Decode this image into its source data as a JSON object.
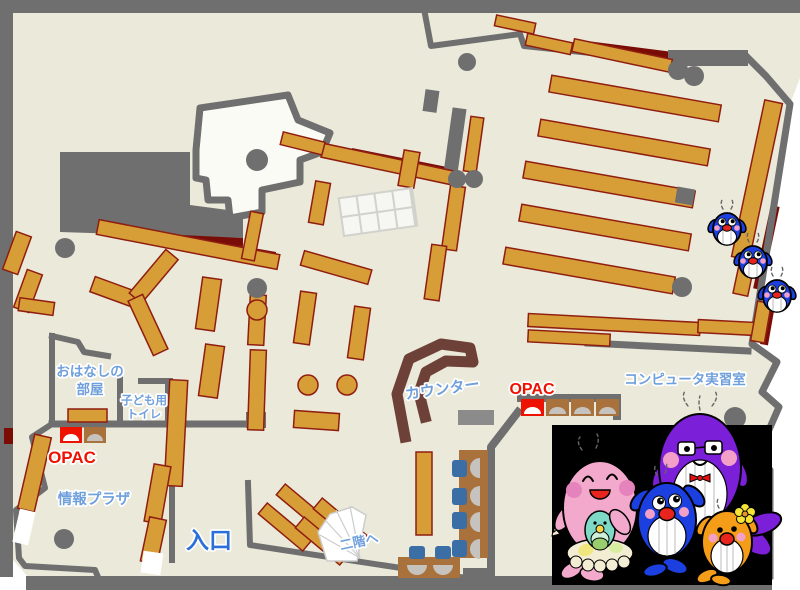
{
  "labels": {
    "story_room": {
      "line1": "おはなしの",
      "line2": "部屋"
    },
    "kids_toilet": {
      "line1": "子ども用",
      "line2": "トイレ"
    },
    "opac_children": "OPAC",
    "info_plaza": "情報プラザ",
    "entrance": "入口",
    "to_second_floor": "二階へ",
    "counter": "カウンター",
    "opac_main": "OPAC",
    "computer_room": "コンピュータ実習室"
  },
  "palette": {
    "floor": "#EBE9D9",
    "wall": "#6F6F6F",
    "shelf": "#D79E38",
    "shelfBorder": "#8F1D10",
    "darkRed": "#7A0C07",
    "counter": "#6E4138",
    "desk": "#A9713B",
    "chair": "#3B6EA4",
    "monitor": "#C6C3BE",
    "opacRed": "#EE1202",
    "labelBlue": "#70A0DC",
    "entranceBlue": "#2D6FD9",
    "roomWhite": "#FBFBF5",
    "charPink": "#F3A9CC",
    "charTeal": "#7ED9C7",
    "charBlue": "#1C40E0",
    "charPurple": "#7B1FD8",
    "charOrange": "#F59C18",
    "charCream": "#F3EDD3",
    "mouthRed": "#E8251C"
  },
  "illustrations": {
    "climbing_whales": "three small blue whale mascots climbing the bookshelf",
    "whale_family": "pink mother whale with teal baby, purple father whale with glasses and bow tie, blue child whale, orange child whale with flower"
  }
}
